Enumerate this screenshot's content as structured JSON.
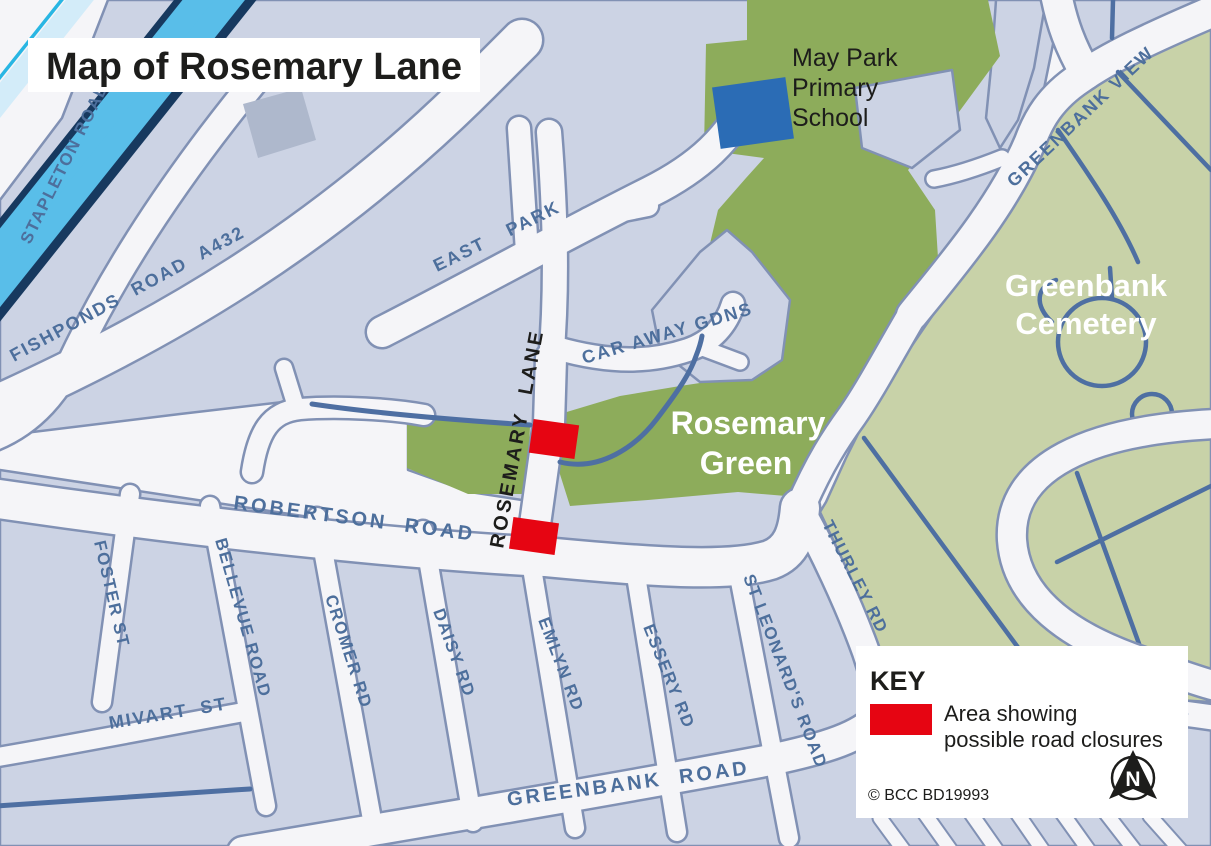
{
  "title": "Map of Rosemary Lane",
  "colors": {
    "block": "#ccd3e4",
    "block_outline": "#8191b4",
    "road": "#f5f5f8",
    "green_dark": "#8dac5b",
    "green_light": "#c8d2a8",
    "water_path": "#4e6fa2",
    "closure_red": "#e60512",
    "school_blue": "#2b6cb5",
    "street_label": "#4d6f9c",
    "dark_text": "#1d1d1b",
    "building": "#aeb8cc",
    "motorway_sky": "#59bee9",
    "motorway_navy": "#17395f",
    "motorway_pale": "#d3ecf9",
    "motorway_cyan": "#29b6e3"
  },
  "streets": {
    "stapleton": "STAPLETON ROAD",
    "fishponds": "FISHPONDS ROAD A432",
    "east_park": "EAST PARK",
    "car_away": "CAR AWAY GDNS",
    "rosemary_lane": "ROSEMARY LANE",
    "greenbank_view": "GREENBANK VIEW",
    "robertson": "ROBERTSON ROAD",
    "thurley": "THURLEY RD",
    "foster": "FOSTER ST",
    "bellevue": "BELLEVUE ROAD",
    "cromer": "CROMER RD",
    "daisy": "DAISY RD",
    "emlyn": "EMLYN RD",
    "essery": "ESSERY RD",
    "st_leonards": "ST LEONARD'S ROAD",
    "mivart": "MIVART ST",
    "greenbank_road": "GREENBANK ROAD"
  },
  "areas": {
    "school_line1": "May Park",
    "school_line2": "Primary",
    "school_line3": "School",
    "rosemary_green_line1": "Rosemary",
    "rosemary_green_line2": "Green",
    "cemetery_line1": "Greenbank",
    "cemetery_line2": "Cemetery"
  },
  "key": {
    "heading": "KEY",
    "closure_line1": "Area showing",
    "closure_line2": "possible road closures",
    "copyright": "© BCC BD19993",
    "compass": "N"
  }
}
